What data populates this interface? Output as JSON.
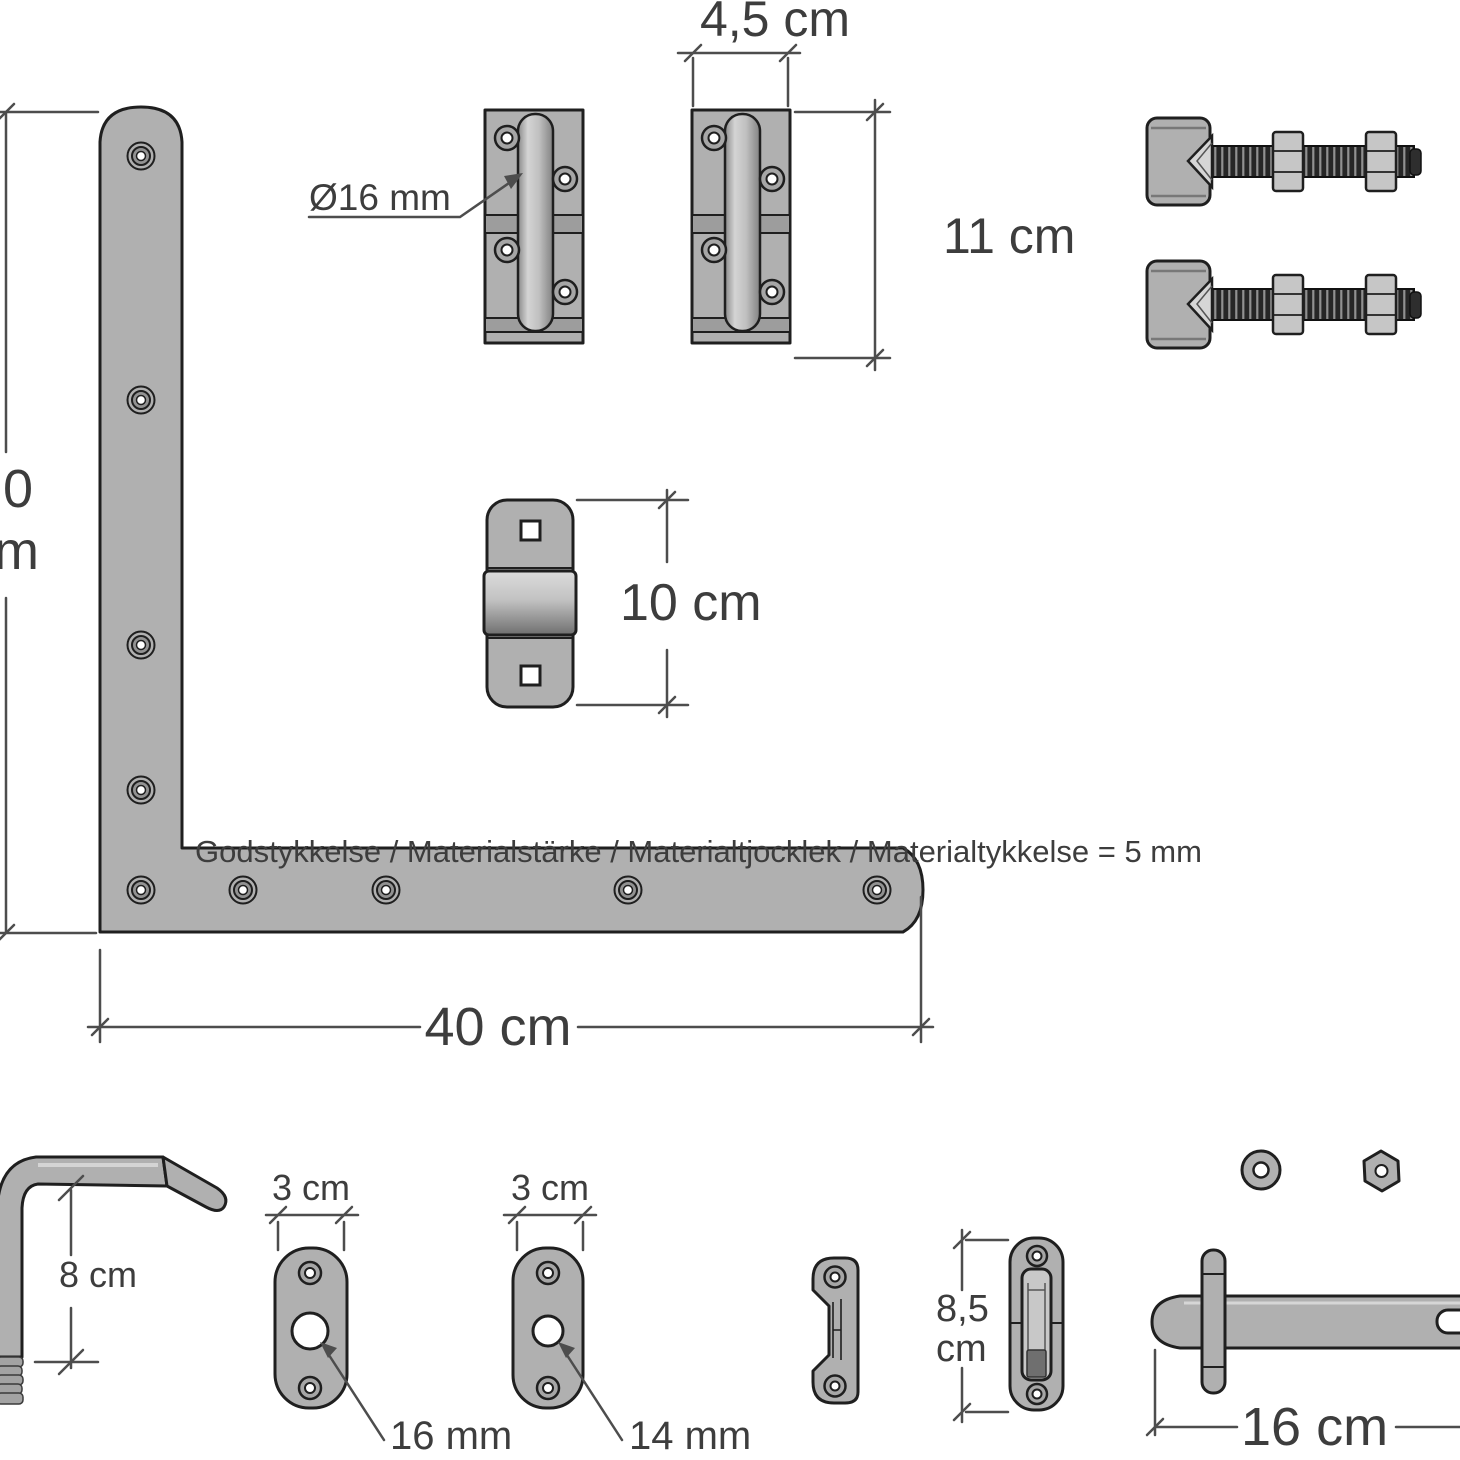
{
  "labels": {
    "hinge_width": "4,5 cm",
    "hinge_height": "11 cm",
    "pin_diameter": "Ø16 mm",
    "gudgeon_height": "10 cm",
    "material_note": "Godstykkelse / Materialstärke / Materialtjocklek / Materialtykkelse = 5 mm",
    "bracket_length": "40 cm",
    "left_partial_top": "0",
    "left_partial_bottom": "m",
    "handle_height": "8 cm",
    "plate16_width": "3 cm",
    "plate14_width": "3 cm",
    "plate16_hole": "16 mm",
    "plate14_hole": "14 mm",
    "keeper_height_value": "8,5",
    "keeper_height_unit": "cm",
    "padbolt_length": "16 cm"
  },
  "colors": {
    "background": "#ffffff",
    "part_fill": "#b0b0b0",
    "outline": "#1f1f1f",
    "dim_line": "#4d4d4d",
    "label_color": "#3d3d3d"
  }
}
